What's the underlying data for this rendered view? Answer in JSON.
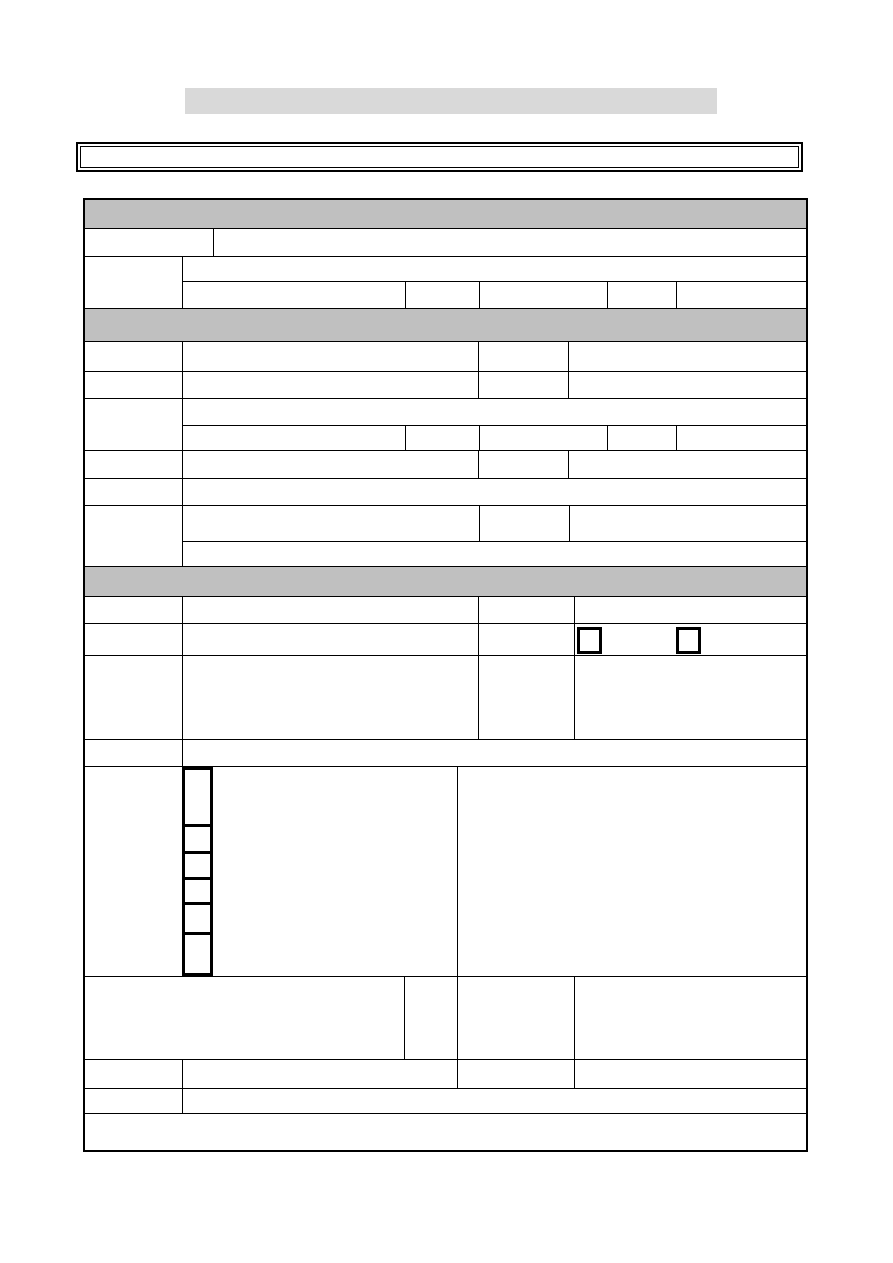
{
  "page": {
    "background": "#ffffff"
  },
  "title_bar": {
    "fill": "#d9d9d9",
    "text": ""
  },
  "notice_box": {
    "fill": "#ffffff",
    "border_color": "#000000",
    "text": ""
  },
  "table": {
    "border_color": "#000000",
    "section_header_fill": "#c0c0c0",
    "section_count": 3,
    "section_headers": [
      {
        "text": ""
      },
      {
        "text": ""
      },
      {
        "text": ""
      }
    ],
    "checkbox_row": {
      "checkbox_count": 2,
      "checkbox_states": [
        "unchecked",
        "unchecked"
      ]
    },
    "entry_box_column": {
      "count": 6,
      "heights_px": [
        54,
        27,
        26,
        25,
        30,
        27
      ]
    },
    "all_cells_empty": true
  }
}
